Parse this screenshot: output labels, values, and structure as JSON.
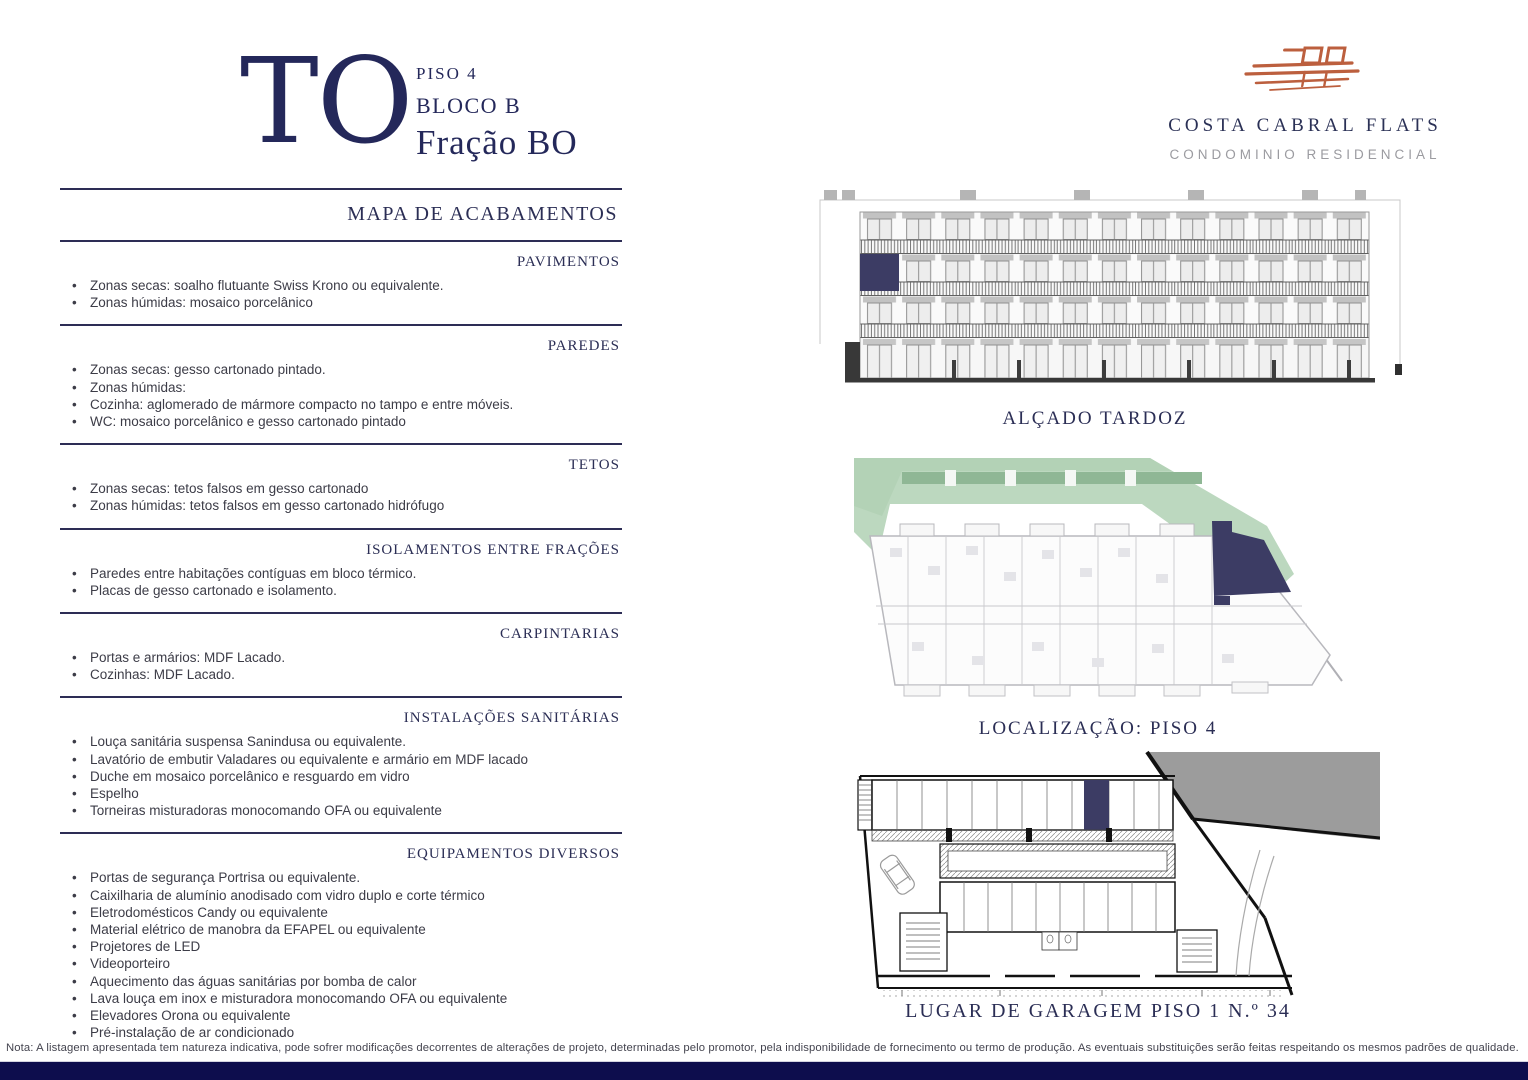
{
  "theme": {
    "navy": "#24285a",
    "heading_navy": "#2b2e55",
    "body_text": "#3c3c47",
    "highlight_navy": "#3c3c64",
    "terracotta": "#bc5f3e",
    "plan_green": "#bcd8bf",
    "footer_bar": "#0d0d4d"
  },
  "header": {
    "unit_code": "TO",
    "floor": "PISO 4",
    "block": "BLOCO B",
    "fraction": "Fração BO"
  },
  "brand": {
    "name": "COSTA CABRAL FLATS",
    "subtitle": "CONDOMINIO RESIDENCIAL",
    "logo_icon": "building-sketch-icon"
  },
  "spec": {
    "title": "MAPA DE ACABAMENTOS",
    "sections": [
      {
        "heading": "PAVIMENTOS",
        "items": [
          "Zonas secas: soalho flutuante Swiss Krono ou equivalente.",
          "Zonas húmidas: mosaico porcelânico"
        ]
      },
      {
        "heading": "PAREDES",
        "items": [
          "Zonas secas: gesso cartonado pintado.",
          "Zonas húmidas:",
          "Cozinha: aglomerado de mármore compacto no tampo e entre móveis.",
          "WC: mosaico porcelânico e gesso cartonado pintado"
        ]
      },
      {
        "heading": "TETOS",
        "items": [
          "Zonas secas: tetos falsos em gesso cartonado",
          "Zonas húmidas: tetos falsos em gesso cartonado hidrófugo"
        ]
      },
      {
        "heading": "ISOLAMENTOS ENTRE FRAÇÕES",
        "items": [
          "Paredes entre habitações contíguas em bloco térmico.",
          "Placas de gesso cartonado e isolamento."
        ]
      },
      {
        "heading": "CARPINTARIAS",
        "items": [
          "Portas e armários: MDF Lacado.",
          "Cozinhas: MDF Lacado."
        ]
      },
      {
        "heading": "INSTALAÇÕES SANITÁRIAS",
        "items": [
          "Louça sanitária suspensa Sanindusa ou equivalente.",
          "Lavatório de embutir Valadares ou equivalente e armário em MDF lacado",
          "Duche em mosaico porcelânico e resguardo em vidro",
          "Espelho",
          "Torneiras misturadoras monocomando OFA ou equivalente"
        ]
      },
      {
        "heading": "EQUIPAMENTOS DIVERSOS",
        "items": [
          "Portas de segurança Portrisa ou equivalente.",
          "Caixilharia de alumínio anodisado com vidro duplo e corte térmico",
          "Eletrodomésticos Candy ou equivalente",
          "Material elétrico de manobra da EFAPEL ou equivalente",
          "Projetores de LED",
          "Videoporteiro",
          "Aquecimento das águas sanitárias por bomba de calor",
          "Lava louça em inox e misturadora monocomando OFA ou equivalente",
          "Elevadores Orona ou equivalente",
          "Pré-instalação de ar condicionado"
        ]
      }
    ]
  },
  "drawings": {
    "elevation_label": "ALÇADO TARDOZ",
    "location_label": "LOCALIZAÇÃO:  PISO 4",
    "garage_label": "LUGAR DE GARAGEM PISO 1  N.º 34"
  },
  "footer": {
    "note": "Nota: A listagem apresentada tem natureza indicativa, pode sofrer modificações decorrentes de alterações de projeto, determinadas pelo promotor, pela indisponibilidade de fornecimento ou termo de produção. As eventuais substituições serão feitas respeitando os mesmos padrões de qualidade."
  }
}
